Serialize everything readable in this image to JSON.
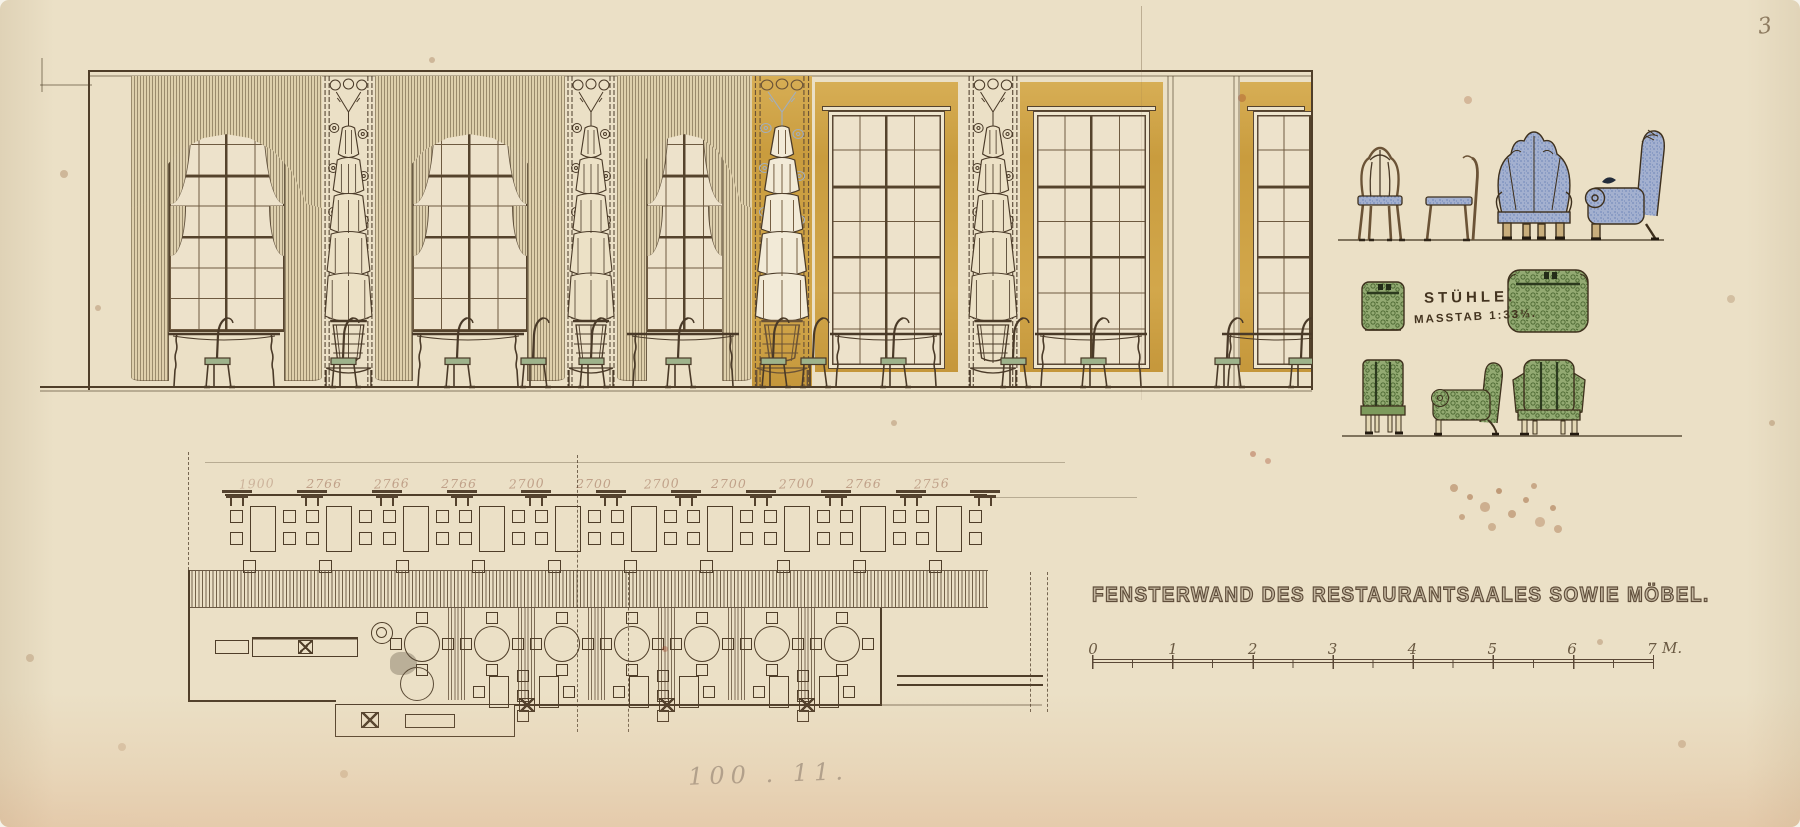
{
  "sheet": {
    "page_number": "3",
    "title": "FENSTERWAND DES RESTAURANTSAALES SOWIE MÖBEL.",
    "pencil_note": "100 . 11."
  },
  "furniture_studies": {
    "label": "STÜHLE.",
    "scale_note": "MASSTAB 1:33⅓."
  },
  "floor_plan": {
    "dimensions_mm": [
      "1900",
      "2766",
      "2766",
      "2766",
      "2700",
      "2700",
      "2700",
      "2700",
      "2700",
      "2766",
      "2756"
    ]
  },
  "scale_bar": {
    "tick_labels": [
      "0",
      "1",
      "2",
      "3",
      "4",
      "5",
      "6",
      "7"
    ],
    "unit_label": "M."
  },
  "palette": {
    "paper": "#ebe0c6",
    "ink": "#4a3a28",
    "gold": "#d0a449",
    "curtain": "#ddceaa",
    "upholstery_blue": "#a3b0cf",
    "upholstery_green": "#93aa72",
    "seat_green": "#9eb38b"
  }
}
